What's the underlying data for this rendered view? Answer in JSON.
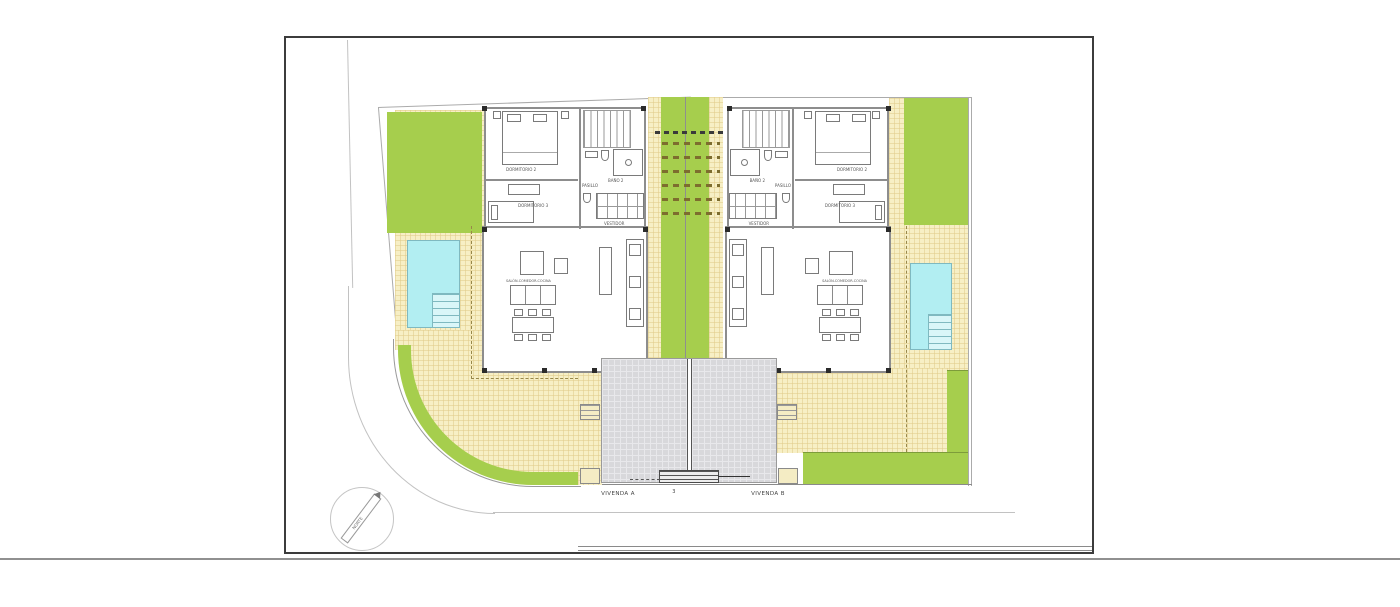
{
  "plan": {
    "plot_number": "3",
    "dwellings": [
      {
        "id": "A",
        "label": "VIVENDA A"
      },
      {
        "id": "B",
        "label": "VIVENDA B"
      }
    ],
    "rooms": {
      "dormitorio2": "DORMITORIO 2",
      "dormitorio3": "DORMITORIO 3",
      "bano2": "BAÑO 2",
      "pasillo": "PASILLO",
      "vestidor": "VESTIDOR",
      "salon": "SALÓN-COMEDOR-COCINA"
    },
    "compass": {
      "label": "NORTE"
    },
    "colors": {
      "grass_green": "#a6ce4d",
      "terrace_cream": "#f7efc5",
      "pool_cyan": "#b2eef2",
      "driveway_gray": "#d8d8db",
      "wall_gray": "#8d8d8d",
      "pier_black": "#2b2b2b",
      "boundary_gray": "#ababab",
      "pergola_dash": "#7d6d2e",
      "frame_dark": "#3c3c3c"
    }
  }
}
